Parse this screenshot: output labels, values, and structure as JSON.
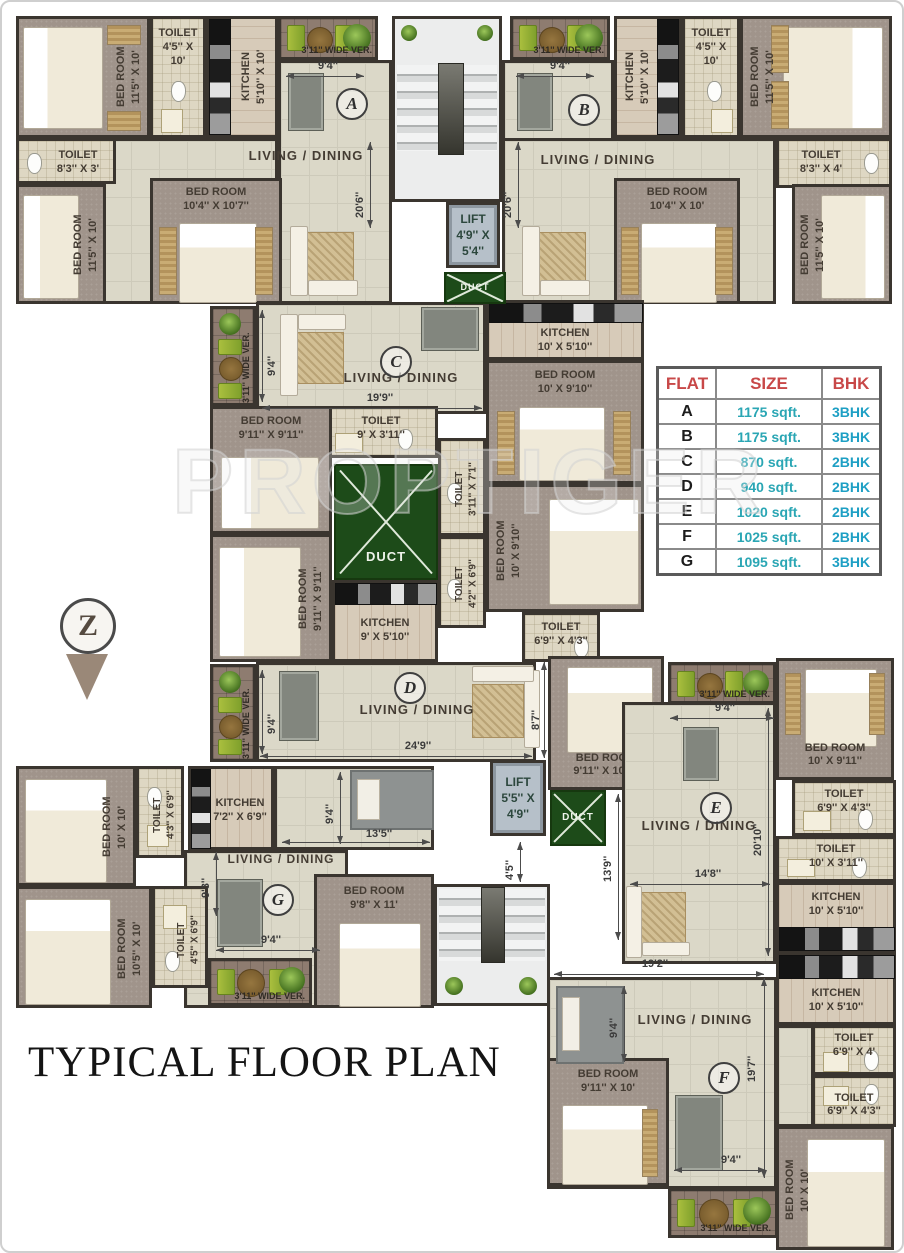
{
  "title": "TYPICAL FLOOR PLAN",
  "watermark": "PROPTIGER",
  "north_letter": "Z",
  "table": {
    "headers": [
      "FLAT",
      "SIZE",
      "BHK"
    ],
    "rows": [
      [
        "A",
        "1175 sqft.",
        "3BHK"
      ],
      [
        "B",
        "1175 sqft.",
        "3BHK"
      ],
      [
        "C",
        "870 sqft.",
        "2BHK"
      ],
      [
        "D",
        "940 sqft.",
        "2BHK"
      ],
      [
        "E",
        "1020 sqft.",
        "2BHK"
      ],
      [
        "F",
        "1025 sqft.",
        "2BHK"
      ],
      [
        "G",
        "1095 sqft.",
        "3BHK"
      ]
    ]
  },
  "core": {
    "lift1": {
      "name": "LIFT",
      "l1": "4'9''",
      "l2": "X 5'4''"
    },
    "lift2": {
      "name": "LIFT",
      "l1": "5'5''",
      "l2": "X 4'9''"
    },
    "duct": "DUCT",
    "dim_45": "4'5''"
  },
  "flats": {
    "a": {
      "letter": "A",
      "living": "LIVING / DINING",
      "dim_w": "9'4''",
      "dim_h": "20'6''",
      "ver": "3'11'' WIDE VER.",
      "bed1": {
        "name": "BED ROOM",
        "dims": "11'5'' X 10'"
      },
      "toilet1": {
        "name": "TOILET",
        "dims": "4'5'' X 10'"
      },
      "kitchen": {
        "name": "KITCHEN",
        "dims": "5'10'' X 10'"
      },
      "toilet2": {
        "name": "TOILET",
        "dims": "8'3'' X 3'"
      },
      "bed2": {
        "name": "BED ROOM",
        "dims": "11'5'' X 10'"
      },
      "bed3": {
        "name": "BED ROOM",
        "dims": "10'4'' X 10'7''"
      }
    },
    "b": {
      "letter": "B",
      "living": "LIVING / DINING",
      "dim_w": "9'4''",
      "dim_h": "20'6''",
      "ver": "3'11'' WIDE VER.",
      "bed1": {
        "name": "BED ROOM",
        "dims": "11'5'' X 10'"
      },
      "toilet1": {
        "name": "TOILET",
        "dims": "4'5'' X 10'"
      },
      "kitchen": {
        "name": "KITCHEN",
        "dims": "5'10'' X 10'"
      },
      "toilet2": {
        "name": "TOILET",
        "dims": "8'3'' X 4'"
      },
      "bed2": {
        "name": "BED ROOM",
        "dims": "11'5'' X 10'"
      },
      "bed3": {
        "name": "BED ROOM",
        "dims": "10'4'' X 10'"
      }
    },
    "c": {
      "letter": "C",
      "living": "LIVING / DINING",
      "dim_w": "19'9''",
      "dim_h": "9'4''",
      "ver": "3'11'' WIDE VER.",
      "kitchen": {
        "name": "KITCHEN",
        "dims": "10' X 5'10''"
      },
      "bed1": {
        "name": "BED ROOM",
        "dims": "10' X 9'10''"
      },
      "toilet1": {
        "name": "TOILET",
        "dims": "9' X 3'11''"
      },
      "bed2": {
        "name": "BED ROOM",
        "dims": "9'11'' X 9'11''"
      }
    },
    "d": {
      "letter": "D",
      "living": "LIVING / DINING",
      "dim_w": "24'9''",
      "dim_h": "9'4''",
      "dim_e": "8'7''",
      "ver": "3'11'' WIDE VER.",
      "bed1": {
        "name": "BED ROOM",
        "dims": "9'11'' X 9'11''"
      },
      "kitchen": {
        "name": "KITCHEN",
        "dims": "9' X 5'10''"
      },
      "bed2": {
        "name": "BED ROOM",
        "dims": "10' X 9'10''"
      },
      "toilet1": {
        "name": "TOILET",
        "dims": "4'2'' X 6'9''"
      },
      "toilet2": {
        "name": "TOILET",
        "dims": "3'11'' X 7'1''"
      },
      "toilet3": {
        "name": "TOILET",
        "dims": "6'9'' X 4'3''"
      }
    },
    "e": {
      "letter": "E",
      "living": "LIVING / DINING",
      "dim_w": "9'4''",
      "dim_h": "20'10''",
      "dim_w2": "14'8''",
      "dim_h2": "13'9''",
      "ver": "3'11'' WIDE VER.",
      "bed1": {
        "name": "BED ROOM",
        "dims": "9'11'' X 10'8''"
      },
      "bed2": {
        "name": "BED ROOM",
        "dims": "10' X 9'11''"
      },
      "toilet1": {
        "name": "TOILET",
        "dims": "6'9'' X 4'3''"
      },
      "toilet2": {
        "name": "TOILET",
        "dims": "10' X 3'11''"
      },
      "kitchen": {
        "name": "KITCHEN",
        "dims": "10' X 5'10''"
      }
    },
    "f": {
      "letter": "F",
      "living": "LIVING / DINING",
      "dim_w": "19'2''",
      "dim_h": "9'4''",
      "dim_h2": "19'7''",
      "dim_w2": "9'4''",
      "ver": "3'11'' WIDE VER.",
      "bed1": {
        "name": "BED ROOM",
        "dims": "9'11'' X 10'"
      },
      "bed2": {
        "name": "BED ROOM",
        "dims": "10' X 10'"
      },
      "toilet1": {
        "name": "TOILET",
        "dims": "6'9'' X 4'"
      },
      "toilet2": {
        "name": "TOILET",
        "dims": "6'9'' X 4'3''"
      },
      "kitchen": {
        "name": "KITCHEN",
        "dims": "10' X 5'10''"
      }
    },
    "g": {
      "letter": "G",
      "living": "LIVING / DINING",
      "dim_w": "13'5''",
      "dim_h": "9'3''",
      "dim_h2": "9'4''",
      "dim_w2": "9'4''",
      "ver": "3'11'' WIDE VER.",
      "bed1": {
        "name": "BED ROOM",
        "dims": "10' X 10'"
      },
      "toilet1": {
        "name": "TOILET",
        "dims": "4'3'' X 6'9''"
      },
      "kitchen": {
        "name": "KITCHEN",
        "dims": "7'2'' X 6'9''"
      },
      "bed2": {
        "name": "BED ROOM",
        "dims": "10'5'' X 10'"
      },
      "toilet2": {
        "name": "TOILET",
        "dims": "4'5'' X 6'9''"
      },
      "bed3": {
        "name": "BED ROOM",
        "dims": "9'8'' X 11'"
      }
    }
  }
}
